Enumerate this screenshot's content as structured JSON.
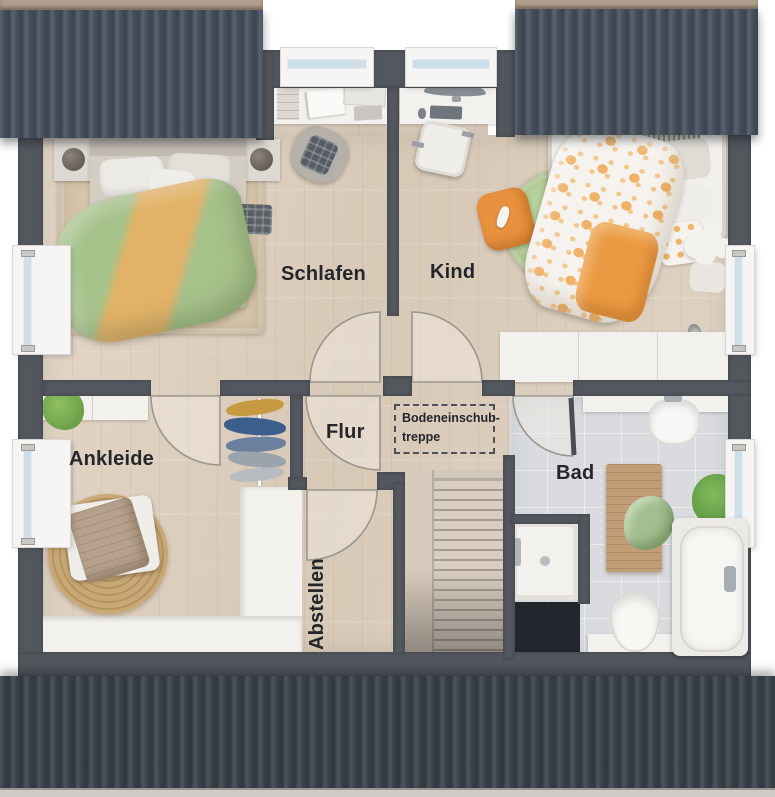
{
  "plan": {
    "title": "Obergeschoss Grundriss",
    "rooms": [
      {
        "id": "schlafen",
        "label": "Schlafen"
      },
      {
        "id": "kind",
        "label": "Kind"
      },
      {
        "id": "ankleide",
        "label": "Ankleide"
      },
      {
        "id": "flur",
        "label": "Flur"
      },
      {
        "id": "abstellen",
        "label": "Abstellen"
      },
      {
        "id": "bad",
        "label": "Bad"
      }
    ],
    "annotations": {
      "attic_hatch": {
        "line1": "Bodeneinschub-",
        "line2": "treppe"
      }
    }
  },
  "colors": {
    "wall": "#53575e",
    "floor": "#dccebf",
    "tile": "#d9dbde",
    "tileline": "#eaecee",
    "roof": "#3f454c",
    "rooftop": "#4b5460",
    "ridge": "#b2a08f",
    "glass": "#cfdfe9",
    "green": "#a6c28b",
    "greenrug": "#b8d39c",
    "orange": "#efb266",
    "orangedeep": "#e8913e",
    "jute": "#c7a375",
    "whitef": "#f3f1ee",
    "swing": "#9b968e",
    "text": "#24262b"
  }
}
